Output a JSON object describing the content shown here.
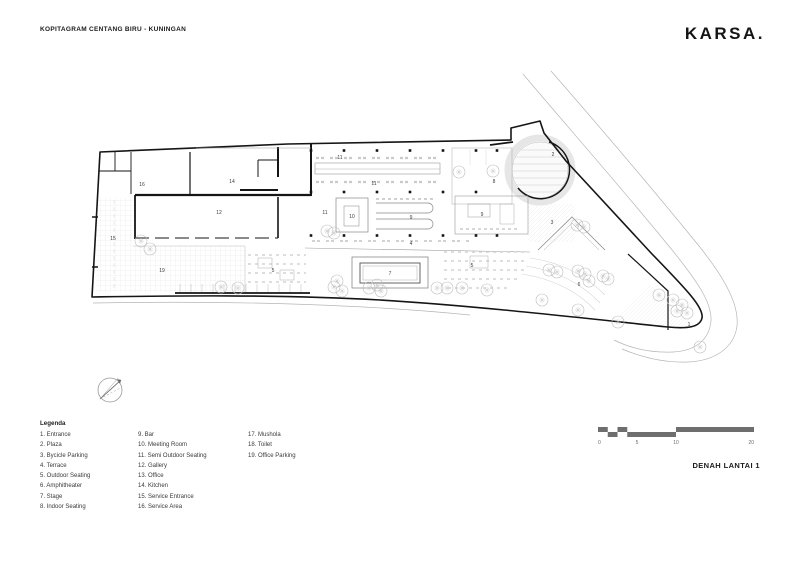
{
  "header": {
    "project_title": "KOPITAGRAM CENTANG BIRU - KUNINGAN",
    "brand": "KARSA."
  },
  "plan": {
    "room_labels": [
      {
        "n": "16",
        "x": 142,
        "y": 186
      },
      {
        "n": "14",
        "x": 232,
        "y": 183
      },
      {
        "n": "12",
        "x": 219,
        "y": 214
      },
      {
        "n": "15",
        "x": 113,
        "y": 240
      },
      {
        "n": "19",
        "x": 162,
        "y": 272
      },
      {
        "n": "5",
        "x": 273,
        "y": 272
      },
      {
        "n": "11",
        "x": 340,
        "y": 159
      },
      {
        "n": "11",
        "x": 374,
        "y": 185
      },
      {
        "n": "11",
        "x": 325,
        "y": 214
      },
      {
        "n": "10",
        "x": 352,
        "y": 218
      },
      {
        "n": "9",
        "x": 411,
        "y": 219
      },
      {
        "n": "9",
        "x": 482,
        "y": 216
      },
      {
        "n": "8",
        "x": 494,
        "y": 183
      },
      {
        "n": "4",
        "x": 411,
        "y": 245
      },
      {
        "n": "7",
        "x": 390,
        "y": 275
      },
      {
        "n": "5",
        "x": 472,
        "y": 267
      },
      {
        "n": "6",
        "x": 579,
        "y": 286
      },
      {
        "n": "2",
        "x": 553,
        "y": 156
      },
      {
        "n": "3",
        "x": 552,
        "y": 224
      },
      {
        "n": "1",
        "x": 689,
        "y": 326
      }
    ]
  },
  "legend": {
    "title": "Legenda",
    "columns": [
      [
        "1. Entrance",
        "2. Plaza",
        "3. Bycicle Parking",
        "4. Terrace",
        "5. Outdoor Seating",
        "6. Amphitheater",
        "7. Stage",
        "8. Indoor Seating"
      ],
      [
        "9. Bar",
        "10. Meeting Room",
        "11. Semi Outdoor Seating",
        "12. Gallery",
        "13. Office",
        "14. Kitchen",
        "15. Service Entrance",
        "16. Service Area"
      ],
      [
        "17. Mushola",
        "18. Toilet",
        "19. Office Parking"
      ]
    ]
  },
  "scalebar": {
    "ticks": [
      "0",
      "5",
      "10",
      "20"
    ],
    "bar_color": "#6e6e6e"
  },
  "titleblock": {
    "drawing_title": "DENAH LANTAI 1"
  }
}
